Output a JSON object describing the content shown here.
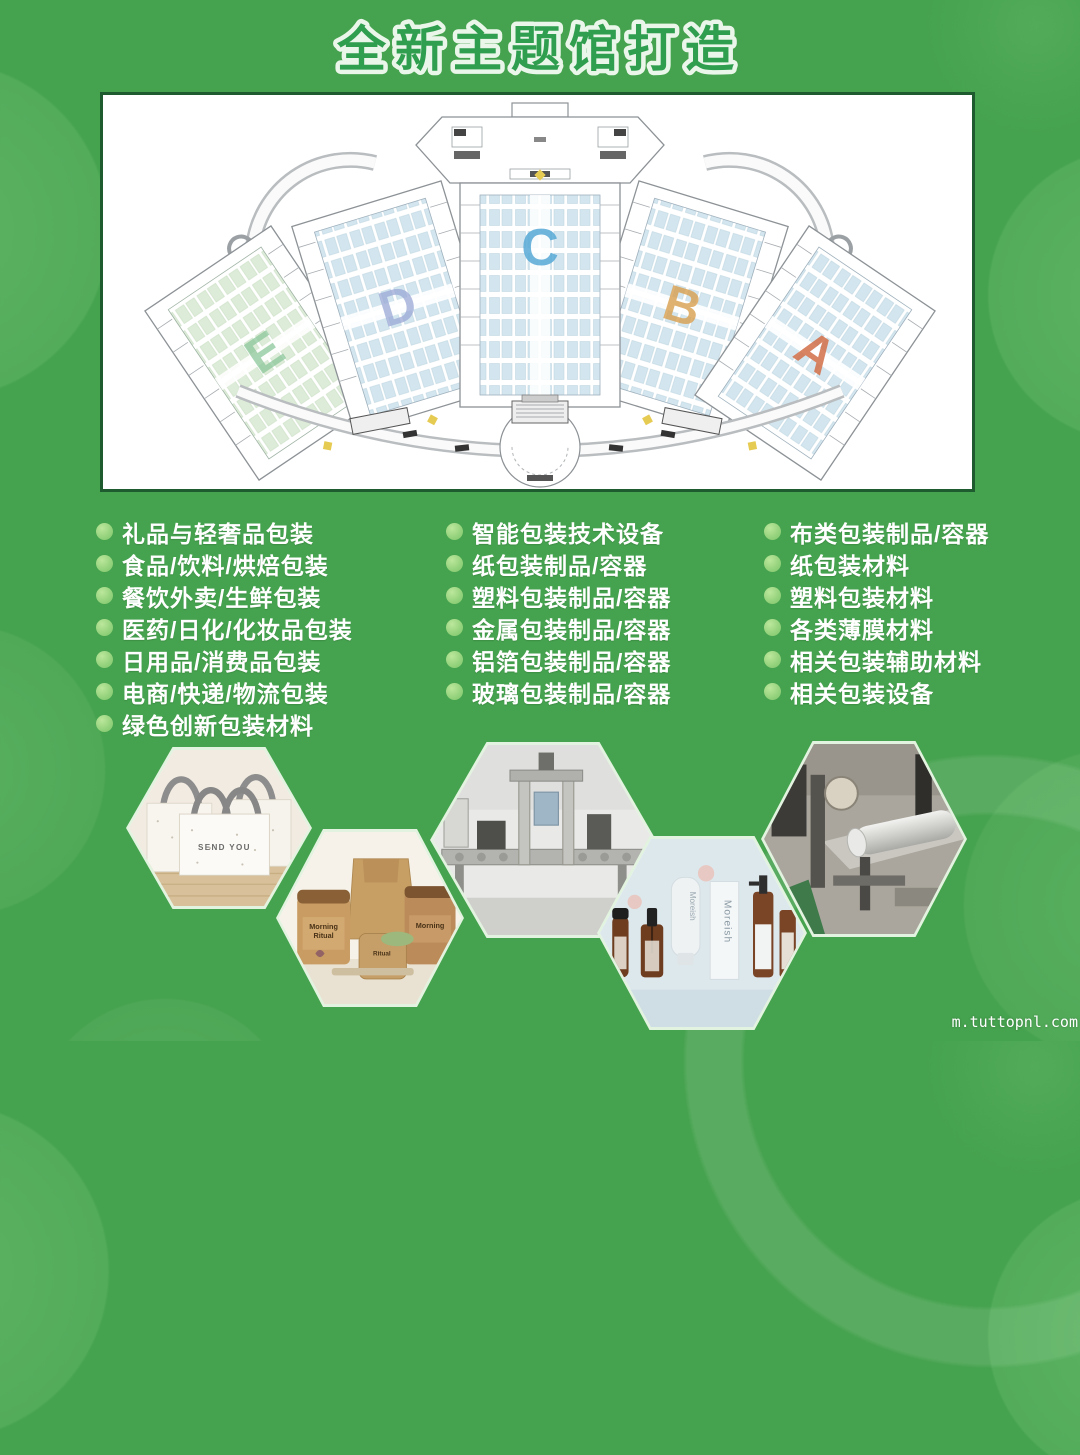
{
  "title": "全新主题馆打造",
  "floor_plan": {
    "halls": [
      {
        "letter": "E",
        "color": "#8cc79a"
      },
      {
        "letter": "D",
        "color": "#9aa8d6"
      },
      {
        "letter": "C",
        "color": "#57a9d6"
      },
      {
        "letter": "B",
        "color": "#d9a050"
      },
      {
        "letter": "A",
        "color": "#d26f48"
      }
    ]
  },
  "categories": {
    "col1": [
      "礼品与轻奢品包装",
      "食品/饮料/烘焙包装",
      "餐饮外卖/生鲜包装",
      "医药/日化/化妆品包装",
      "日用品/消费品包装",
      "电商/快递/物流包装",
      "绿色创新包装材料"
    ],
    "col2": [
      "智能包装技术设备",
      "纸包装制品/容器",
      "塑料包装制品/容器",
      "金属包装制品/容器",
      "铝箔包装制品/容器",
      "玻璃包装制品/容器"
    ],
    "col3": [
      "布类包装制品/容器",
      "纸包装材料",
      "塑料包装材料",
      "各类薄膜材料",
      "相关包装辅助材料",
      "相关包装设备"
    ]
  },
  "photos": {
    "bag_text": "SEND YOU",
    "jar_brand_line1": "Morning",
    "jar_brand_line2": "Ritual",
    "cosmetic_brand": "Moreish"
  },
  "watermark": "m.tuttopnl.com",
  "colors": {
    "background": "#45a24e",
    "title_green": "#2f9e4f",
    "panel_border": "#1e5c2f",
    "bullet_green": "#94d27c",
    "booth_blue": "#d3e6ef",
    "booth_green": "#ddecd8"
  }
}
